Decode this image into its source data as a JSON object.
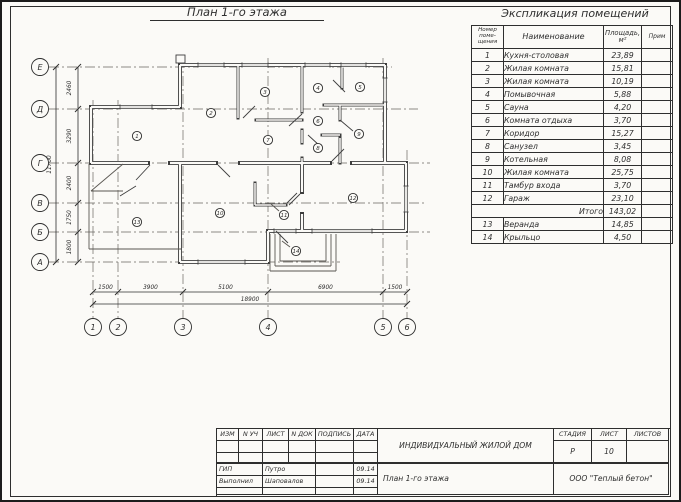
{
  "colors": {
    "ink": "#2e2e2e",
    "wall": "#3d3d3d",
    "paper": "#fbfaf7"
  },
  "plan": {
    "title": "План 1-го этажа",
    "row_axes": [
      "Е",
      "Д",
      "Г",
      "В",
      "Б",
      "А"
    ],
    "row_dims": [
      "2460",
      "3290",
      "2400",
      "1750",
      "1800"
    ],
    "row_total": "11700",
    "col_axes": [
      "1",
      "2",
      "3",
      "4",
      "5",
      "6"
    ],
    "col_dims": [
      "1500",
      "3900",
      "5100",
      "6900",
      "1500"
    ],
    "col_total": "18900",
    "rooms": [
      "1",
      "2",
      "3",
      "4",
      "5",
      "6",
      "7",
      "8",
      "9",
      "10",
      "11",
      "12",
      "13",
      "14"
    ]
  },
  "explication": {
    "title": "Экспликация помещений",
    "header_num_lines": [
      "Номер",
      "поме-",
      "щения"
    ],
    "header_name": "Наименование",
    "header_area_lines": [
      "Площадь,",
      "м²"
    ],
    "header_note": "Прим",
    "rows": [
      {
        "num": "1",
        "name": "Кухня-столовая",
        "area": "23,89",
        "note": ""
      },
      {
        "num": "2",
        "name": "Жилая комната",
        "area": "15,81",
        "note": ""
      },
      {
        "num": "3",
        "name": "Жилая комната",
        "area": "10,19",
        "note": ""
      },
      {
        "num": "4",
        "name": "Помывочная",
        "area": "5,88",
        "note": ""
      },
      {
        "num": "5",
        "name": "Сауна",
        "area": "4,20",
        "note": ""
      },
      {
        "num": "6",
        "name": "Комната отдыха",
        "area": "3,70",
        "note": ""
      },
      {
        "num": "7",
        "name": "Коридор",
        "area": "15,27",
        "note": ""
      },
      {
        "num": "8",
        "name": "Санузел",
        "area": "3,45",
        "note": ""
      },
      {
        "num": "9",
        "name": "Котельная",
        "area": "8,08",
        "note": ""
      },
      {
        "num": "10",
        "name": "Жилая комната",
        "area": "25,75",
        "note": ""
      },
      {
        "num": "11",
        "name": "Тамбур входа",
        "area": "3,70",
        "note": ""
      },
      {
        "num": "12",
        "name": "Гараж",
        "area": "23,10",
        "note": ""
      },
      {
        "total": true,
        "name": "Итого",
        "area": "143,02",
        "note": ""
      },
      {
        "num": "13",
        "name": "Веранда",
        "area": "14,85",
        "note": ""
      },
      {
        "num": "14",
        "name": "Крыльцо",
        "area": "4,50",
        "note": ""
      }
    ]
  },
  "title_block": {
    "cols": [
      "ИЗМ",
      "N УЧ",
      "ЛИСТ",
      "N ДОК",
      "ПОДПИСЬ",
      "ДАТА"
    ],
    "sign_rows": [
      {
        "role": "ГИП",
        "name": "Путро",
        "sign": "",
        "date": "09.14"
      },
      {
        "role": "Выполнил",
        "name": "Шаповалов",
        "sign": "",
        "date": "09.14"
      }
    ],
    "project": "ИНДИВИДУАЛЬНЫЙ ЖИЛОЙ ДОМ",
    "sheet_title": "План 1-го этажа",
    "stage_cols": [
      "СТАДИЯ",
      "ЛИСТ",
      "ЛИСТОВ"
    ],
    "stage": "Р",
    "sheet": "10",
    "sheets_total": "",
    "company": "ООО \"Теплый бетон\""
  }
}
